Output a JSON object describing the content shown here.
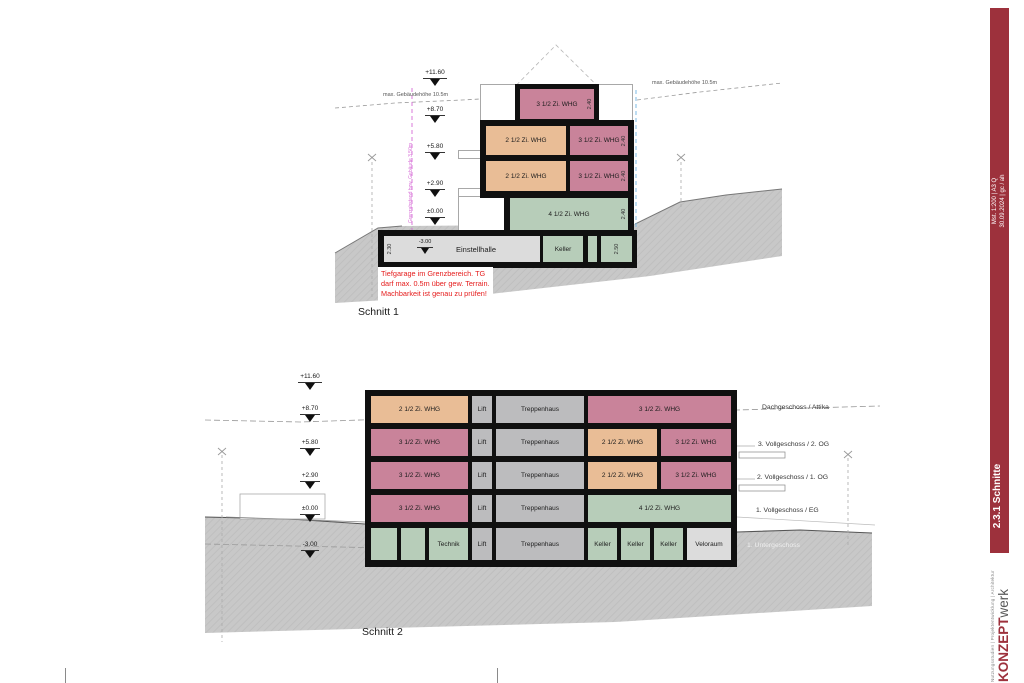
{
  "sidebar": {
    "scale_note": "Mst. 1:200 | A3 Q",
    "date_note": "30.09.2024 | gc / ah",
    "sheet_title": "2.3.1 Schnitte",
    "brand_bold": "KONZEPT",
    "brand_light": "werk",
    "brand_tagline": "Nutzungsstudien | Projektentwicklung | Architektur",
    "bar_color": "#9d313c"
  },
  "colors": {
    "flat_35_pink": "#c9839a",
    "flat_25_orange": "#e9bd96",
    "flat_45_green": "#b7cdb9",
    "core_gray": "#bcbcbe",
    "garage_gray": "#dcdcdc",
    "wall_black": "#101010",
    "terrain_gray": "#c8c8c8",
    "annotation_red": "#e51c1c",
    "boundary_magenta": "#d66bd6",
    "bauline_blue": "#6fb4e4"
  },
  "schnitt1": {
    "title": "Schnitt 1",
    "elevations": [
      "+11.60",
      "+8.70",
      "+5.80",
      "+2.90",
      "±0.00"
    ],
    "basement_elevation": "-3.00",
    "max_height_left": "max. Gebäudehöhe 10.5m",
    "max_height_right": "max. Gebäudehöhe 10.5m",
    "boundary_note": "Grenzabstand bzw. Gebäude 3.50m",
    "bauline_note": "Baulinie + 3.50m",
    "floors": {
      "attika": "3 1/2 Zi. WHG",
      "og2_left": "2 1/2 Zi. WHG",
      "og2_right": "3 1/2 Zi. WHG",
      "og1_left": "2 1/2 Zi. WHG",
      "og1_right": "3 1/2 Zi. WHG",
      "eg": "4 1/2 Zi. WHG",
      "ug_garage": "Einstellhalle",
      "ug_keller": "Keller"
    },
    "dims": {
      "room_height": "2.40",
      "garage_height": "2.30",
      "keller_height": "2.50"
    },
    "annotation": [
      "Tiefgarage im Grenzbereich. TG",
      "darf max. 0.5m über gew. Terrain.",
      "Machbarkeit ist genau zu prüfen!"
    ]
  },
  "schnitt2": {
    "title": "Schnitt 2",
    "elevations": [
      "+11.60",
      "+8.70",
      "+5.80",
      "+2.90",
      "±0.00",
      "-3.00"
    ],
    "floor_labels": [
      "Dachgeschoss / Attika",
      "3. Vollgeschoss / 2. OG",
      "2. Vollgeschoss / 1. OG",
      "1. Vollgeschoss / EG",
      "1. Untergeschoss"
    ],
    "rows": [
      {
        "cells": [
          {
            "label": "2 1/2 Zi. WHG"
          },
          {
            "label": "Lift"
          },
          {
            "label": "Treppenhaus"
          },
          {
            "label": "3 1/2 Zi. WHG"
          }
        ]
      },
      {
        "cells": [
          {
            "label": "3 1/2 Zi. WHG"
          },
          {
            "label": "Lift"
          },
          {
            "label": "Treppenhaus"
          },
          {
            "label": "2 1/2 Zi. WHG"
          },
          {
            "label": "3 1/2 Zi. WHG"
          }
        ]
      },
      {
        "cells": [
          {
            "label": "3 1/2 Zi. WHG"
          },
          {
            "label": "Lift"
          },
          {
            "label": "Treppenhaus"
          },
          {
            "label": "2 1/2 Zi. WHG"
          },
          {
            "label": "3 1/2 Zi. WHG"
          }
        ]
      },
      {
        "cells": [
          {
            "label": "3 1/2 Zi. WHG"
          },
          {
            "label": "Lift"
          },
          {
            "label": "Treppenhaus"
          },
          {
            "label": "4 1/2 Zi. WHG"
          }
        ]
      },
      {
        "cells": [
          {
            "label": ""
          },
          {
            "label": ""
          },
          {
            "label": "Technik"
          },
          {
            "label": "Lift"
          },
          {
            "label": "Treppenhaus"
          },
          {
            "label": "Keller"
          },
          {
            "label": "Keller"
          },
          {
            "label": "Keller"
          },
          {
            "label": "Veloraum"
          }
        ]
      }
    ]
  }
}
